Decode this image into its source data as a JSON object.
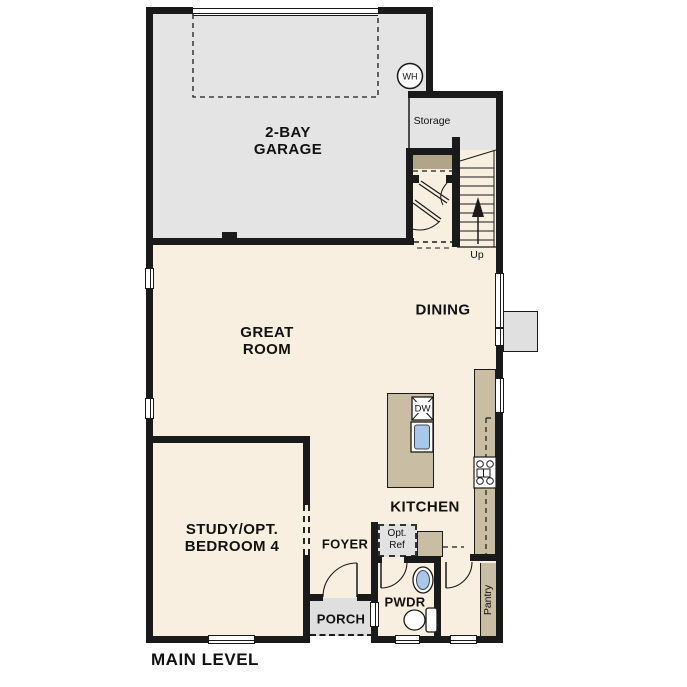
{
  "title": "MAIN LEVEL",
  "colors": {
    "wall": "#1a1a1a",
    "garage_fill": "#e4e4e4",
    "living_fill": "#f8efe0",
    "counter_fill": "#c9bda3",
    "shelf_fill": "#b2a489",
    "porch_fill": "#dfdfdf",
    "ref_fill": "#e2e2e2",
    "sink_fill": "#a9c7e9",
    "bump_fill": "#e0e0e0"
  },
  "rooms": {
    "garage": {
      "line1": "2-BAY",
      "line2": "GARAGE"
    },
    "storage": {
      "label": "Storage"
    },
    "great_room": {
      "line1": "GREAT",
      "line2": "ROOM"
    },
    "dining": {
      "label": "DINING"
    },
    "kitchen": {
      "label": "KITCHEN"
    },
    "study": {
      "line1": "STUDY/OPT.",
      "line2": "BEDROOM 4"
    },
    "foyer": {
      "label": "FOYER"
    },
    "porch": {
      "label": "PORCH"
    },
    "powder": {
      "label": "PWDR"
    },
    "pantry": {
      "label": "Pantry"
    }
  },
  "fixtures": {
    "water_heater": "WH",
    "dishwasher": "DW",
    "opt_ref": {
      "line1": "Opt.",
      "line2": "Ref"
    },
    "stairs": {
      "direction": "Up"
    }
  }
}
